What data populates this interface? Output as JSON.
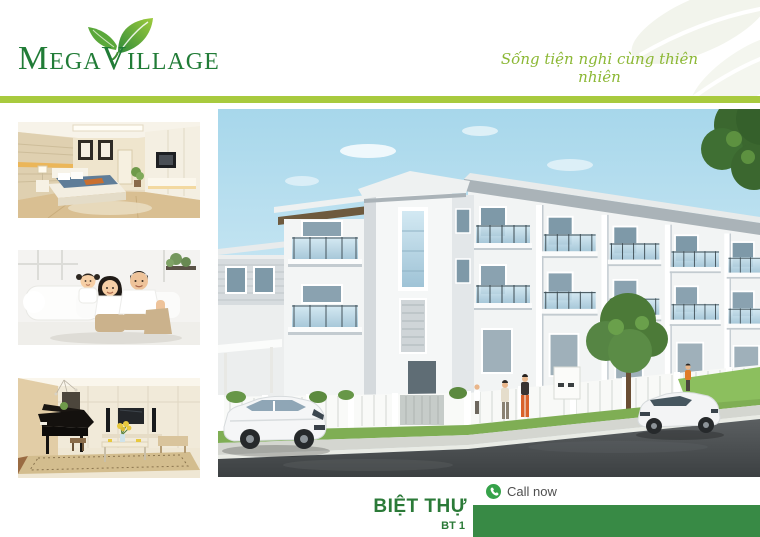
{
  "brand": {
    "logo_text": "MegaVillage",
    "logo_color": "#217c37",
    "leaf_icon": "leaf-icon",
    "tagline": "Sống tiện nghi cùng thiên nhiên",
    "tagline_color": "#8cb835",
    "divider_color": "#a8ca3e"
  },
  "gallery": {
    "items": [
      {
        "name": "bedroom-interior-photo"
      },
      {
        "name": "happy-family-photo"
      },
      {
        "name": "living-room-piano-photo"
      }
    ]
  },
  "hero": {
    "name": "villa-street-render"
  },
  "footer": {
    "call_now_label": "Call now",
    "phone_icon_color": "#36a24a",
    "title": "BIỆT THỰ",
    "subtitle": "BT 1",
    "title_color": "#2b7a38",
    "bar_color": "#388a45"
  }
}
